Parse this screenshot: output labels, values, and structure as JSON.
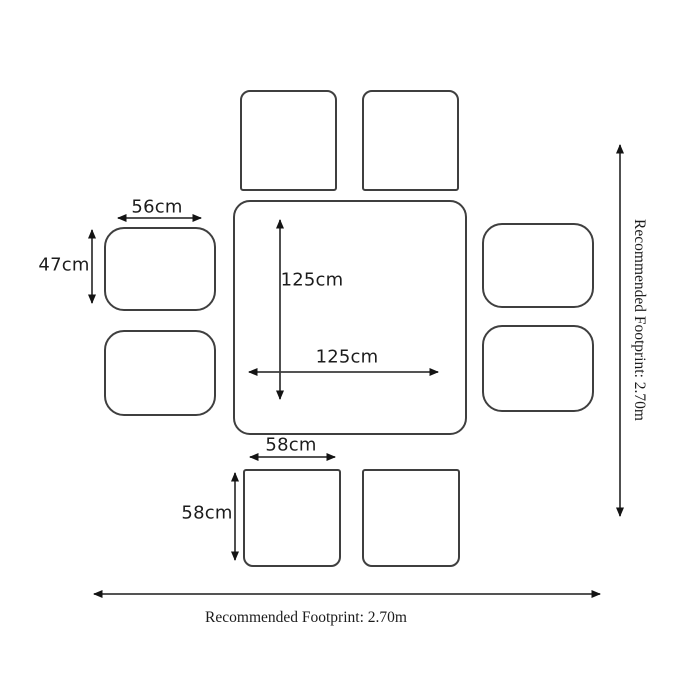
{
  "diagram": {
    "type": "furniture-footprint-diagram",
    "colors": {
      "background": "#ffffff",
      "outline": "#3f3f3f",
      "arrow": "#3c3c3c",
      "arrow_head": "#141414",
      "text": "#1c1c1c"
    },
    "shapes": {
      "table": "square dining table",
      "top_stools": 2,
      "bottom_stools": 2,
      "left_chairs": 2,
      "right_chairs": 2
    },
    "dimensions": {
      "side_chair_width": "56cm",
      "side_chair_depth": "47cm",
      "table_depth": "125cm",
      "table_width": "125cm",
      "stool_width": "58cm",
      "stool_depth": "58cm"
    },
    "footprint": {
      "bottom_label": "Recommended Footprint: 2.70m",
      "right_label": "Recommended Footprint: 2.70m"
    }
  }
}
